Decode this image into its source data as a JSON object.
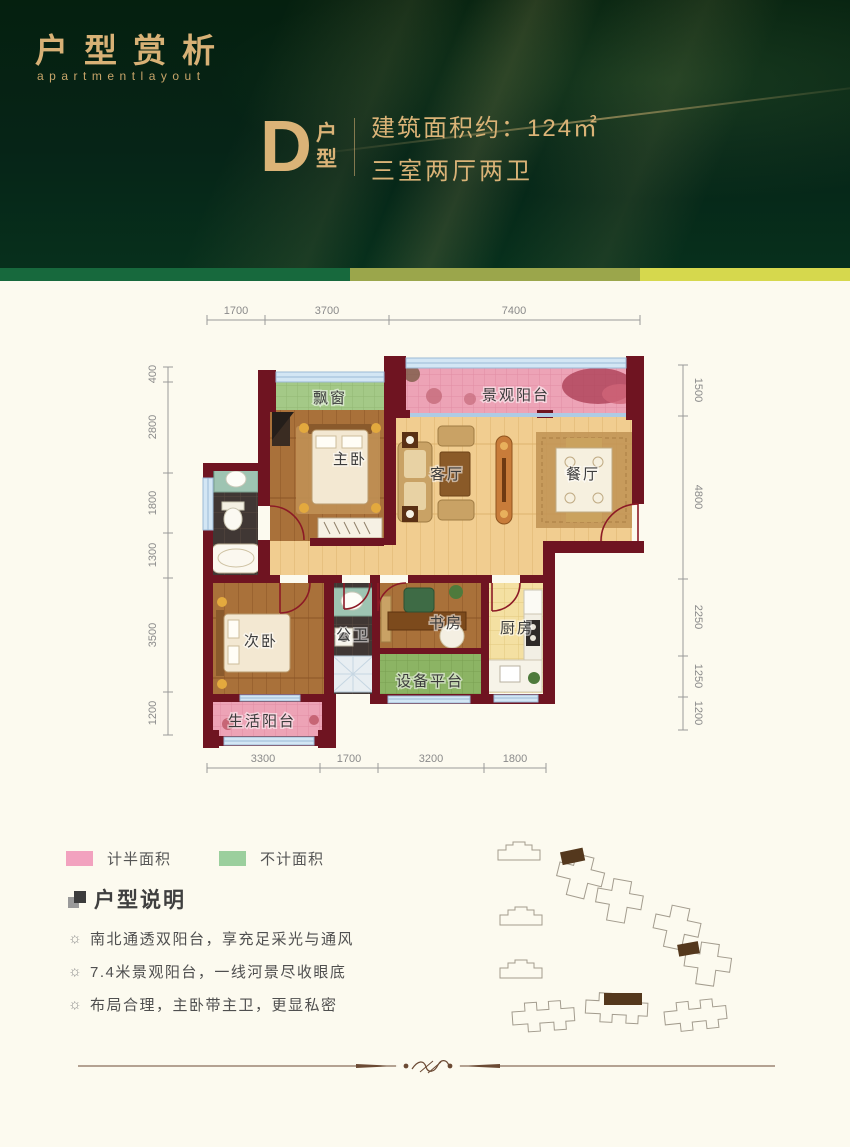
{
  "header": {
    "title": "户型赏析",
    "subtitle": "apartmentlayout",
    "unit": {
      "letter": "D",
      "suffix": "户型",
      "area": "建筑面积约：124㎡",
      "rooms": "三室两厅两卫"
    }
  },
  "colors": {
    "header_green": "#062417",
    "gold": "#d8b176",
    "band": [
      "#17693d",
      "#9ba64b",
      "#d6d84d"
    ],
    "wall_maroon": "#6f1421",
    "balcony_pink": "#eda3b6",
    "bay_green": "#a4c987",
    "legend_pink": "#f2a2bf",
    "legend_green": "#9bcf9d"
  },
  "plan": {
    "rooms": {
      "bay": "飘窗",
      "view_balcony": "景观阳台",
      "master": "主卧",
      "living": "客厅",
      "dining": "餐厅",
      "second": "次卧",
      "bath2": "公卫",
      "study": "书房",
      "kitchen": "厨房",
      "equipment": "设备平台",
      "life_balcony": "生活阳台"
    },
    "dims": {
      "top": [
        "1700",
        "3700",
        "7400"
      ],
      "bottom": [
        "3300",
        "1700",
        "3200",
        "1800"
      ],
      "left": [
        "400",
        "2800",
        "1800",
        "1300",
        "3500",
        "1200"
      ],
      "right": [
        "1500",
        "4800",
        "2250",
        "1250",
        "1200"
      ]
    }
  },
  "legend": {
    "half_label": "计半面积",
    "none_label": "不计面积"
  },
  "notes": {
    "heading": "户型说明",
    "bullet": "☼",
    "items": [
      "南北通透双阳台，享充足采光与通风",
      "7.4米景观阳台，一线河景尽收眼底",
      "布局合理，主卧带主卫，更显私密"
    ]
  }
}
